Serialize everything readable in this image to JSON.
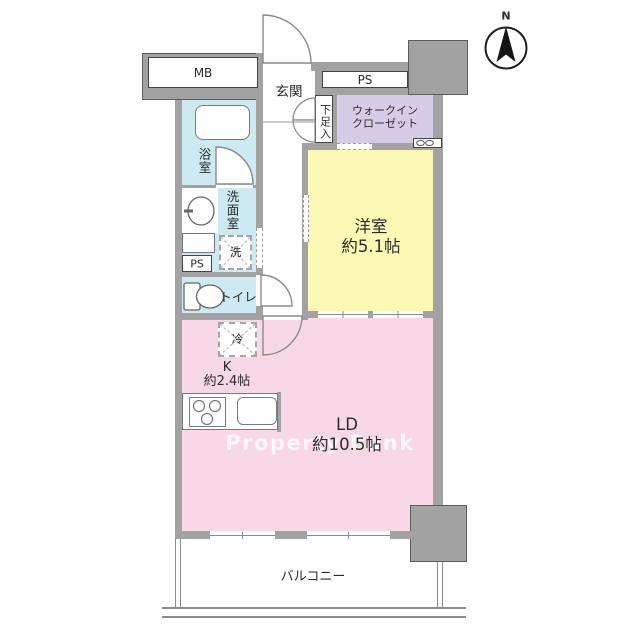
{
  "title": "1LDK apartment floor plan",
  "compass": {
    "north_label": "N"
  },
  "watermark": "Property Bank",
  "labels": {
    "mb": "MB",
    "ps_top": "PS",
    "genkan": "玄関",
    "shoe_box": "下足入",
    "walk_in_closet_line1": "ウォークイン",
    "walk_in_closet_line2": "クローゼット",
    "bath": "浴室",
    "washroom": "洗面室",
    "washer": "洗",
    "ps_small": "PS",
    "toilet": "トイレ",
    "western_room_name": "洋室",
    "western_room_size": "約5.1帖",
    "fridge": "冷",
    "kitchen_name": "K",
    "kitchen_size": "約2.4帖",
    "ld_name": "LD",
    "ld_size": "約10.5帖",
    "balcony": "バルコニー"
  },
  "colors": {
    "wall": "#a2a2a2",
    "pink": "#f8d8e6",
    "yellow": "#fbf9b4",
    "purple": "#d6cce8",
    "blue": "#cdeaf2"
  }
}
